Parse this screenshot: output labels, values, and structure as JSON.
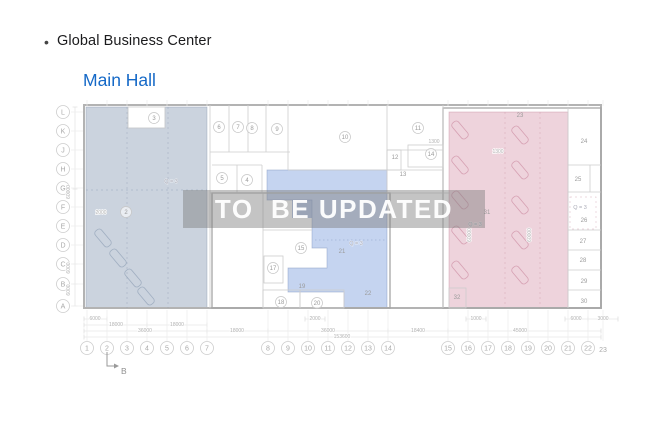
{
  "header": {
    "bullet": "•",
    "title": "Global Business Center",
    "subtitle": "Main Hall"
  },
  "watermark": {
    "text": "TO  BE UPDATED"
  },
  "colors": {
    "subtitle_blue": "#1569c7",
    "left_zone": "rgba(151,168,190,0.50)",
    "middle_zone": "rgba(133,166,224,0.48)",
    "middle_zone_dark": "rgba(120,150,210,0.55)",
    "right_zone": "rgba(214,151,172,0.42)",
    "watermark_band": "rgba(125,125,125,0.45)"
  },
  "plan": {
    "section_marker": "B",
    "row_labels": [
      {
        "t": "L",
        "y": 112
      },
      {
        "t": "K",
        "y": 131
      },
      {
        "t": "J",
        "y": 150
      },
      {
        "t": "H",
        "y": 169
      },
      {
        "t": "G",
        "y": 188
      },
      {
        "t": "F",
        "y": 207
      },
      {
        "t": "E",
        "y": 226
      },
      {
        "t": "D",
        "y": 245
      },
      {
        "t": "C",
        "y": 264
      },
      {
        "t": "B",
        "y": 284
      },
      {
        "t": "A",
        "y": 306
      }
    ],
    "col_labels": [
      {
        "t": "1",
        "x": 87
      },
      {
        "t": "2",
        "x": 107
      },
      {
        "t": "3",
        "x": 127
      },
      {
        "t": "4",
        "x": 147
      },
      {
        "t": "5",
        "x": 167
      },
      {
        "t": "6",
        "x": 187
      },
      {
        "t": "7",
        "x": 207
      },
      {
        "t": "8",
        "x": 268
      },
      {
        "t": "9",
        "x": 288
      },
      {
        "t": "10",
        "x": 308
      },
      {
        "t": "11",
        "x": 328
      },
      {
        "t": "12",
        "x": 348
      },
      {
        "t": "13",
        "x": 368
      },
      {
        "t": "14",
        "x": 388
      },
      {
        "t": "15",
        "x": 448
      },
      {
        "t": "16",
        "x": 468
      },
      {
        "t": "17",
        "x": 488
      },
      {
        "t": "18",
        "x": 508
      },
      {
        "t": "19",
        "x": 528
      },
      {
        "t": "20",
        "x": 548
      },
      {
        "t": "21",
        "x": 568
      },
      {
        "t": "22",
        "x": 588
      },
      {
        "t": "23",
        "x": 603,
        "plain": true,
        "y": 352
      }
    ],
    "rooms": [
      {
        "t": "2",
        "x": 126,
        "y": 212,
        "c": true
      },
      {
        "t": "3",
        "x": 154,
        "y": 118,
        "c": true
      },
      {
        "t": "5",
        "x": 222,
        "y": 178,
        "c": true
      },
      {
        "t": "4",
        "x": 247,
        "y": 180,
        "c": true
      },
      {
        "t": "6",
        "x": 219,
        "y": 127,
        "c": true
      },
      {
        "t": "7",
        "x": 238,
        "y": 127,
        "c": true
      },
      {
        "t": "8",
        "x": 252,
        "y": 128,
        "c": true
      },
      {
        "t": "9",
        "x": 277,
        "y": 129,
        "c": true
      },
      {
        "t": "10",
        "x": 345,
        "y": 137,
        "c": true
      },
      {
        "t": "11",
        "x": 418,
        "y": 128,
        "c": true
      },
      {
        "t": "12",
        "x": 395,
        "y": 157
      },
      {
        "t": "13",
        "x": 403,
        "y": 174
      },
      {
        "t": "14",
        "x": 431,
        "y": 154,
        "c": true
      },
      {
        "t": "15",
        "x": 301,
        "y": 248,
        "c": true
      },
      {
        "t": "17",
        "x": 273,
        "y": 268,
        "c": true
      },
      {
        "t": "18",
        "x": 281,
        "y": 302,
        "c": true
      },
      {
        "t": "19",
        "x": 302,
        "y": 286
      },
      {
        "t": "20",
        "x": 317,
        "y": 303,
        "c": true
      },
      {
        "t": "21",
        "x": 342,
        "y": 251
      },
      {
        "t": "22",
        "x": 368,
        "y": 293
      },
      {
        "t": "23",
        "x": 520,
        "y": 115
      },
      {
        "t": "24",
        "x": 584,
        "y": 141
      },
      {
        "t": "25",
        "x": 578,
        "y": 179
      },
      {
        "t": "26",
        "x": 584,
        "y": 220
      },
      {
        "t": "27",
        "x": 583,
        "y": 241
      },
      {
        "t": "28",
        "x": 583,
        "y": 260
      },
      {
        "t": "29",
        "x": 584,
        "y": 281
      },
      {
        "t": "30",
        "x": 584,
        "y": 301
      },
      {
        "t": "31",
        "x": 487,
        "y": 212
      },
      {
        "t": "32",
        "x": 457,
        "y": 297
      }
    ],
    "texts": [
      {
        "t": "6000",
        "x": 95,
        "y": 320
      },
      {
        "t": "18000",
        "x": 116,
        "y": 326
      },
      {
        "t": "18000",
        "x": 177,
        "y": 326
      },
      {
        "t": "36000",
        "x": 145,
        "y": 332
      },
      {
        "t": "18000",
        "x": 237,
        "y": 332
      },
      {
        "t": "2000",
        "x": 315,
        "y": 320
      },
      {
        "t": "36000",
        "x": 328,
        "y": 332
      },
      {
        "t": "18400",
        "x": 418,
        "y": 332
      },
      {
        "t": "1000",
        "x": 476,
        "y": 320
      },
      {
        "t": "45000",
        "x": 520,
        "y": 332
      },
      {
        "t": "6000",
        "x": 576,
        "y": 320
      },
      {
        "t": "3000",
        "x": 603,
        "y": 320
      },
      {
        "t": "153600",
        "x": 342,
        "y": 338
      },
      {
        "t": "60000",
        "x": 70,
        "y": 192,
        "r": -90
      },
      {
        "t": "6000",
        "x": 70,
        "y": 268,
        "r": -90
      },
      {
        "t": "6000",
        "x": 70,
        "y": 290,
        "r": -90
      },
      {
        "t": "60000",
        "x": 471,
        "y": 235,
        "r": -90
      },
      {
        "t": "60000",
        "x": 531,
        "y": 235,
        "r": -90
      },
      {
        "t": "1300",
        "x": 434,
        "y": 143
      },
      {
        "t": "1300",
        "x": 498,
        "y": 153
      },
      {
        "t": "2000",
        "x": 101,
        "y": 214
      },
      {
        "t": "Q = 3",
        "x": 171,
        "y": 183,
        "a": true
      },
      {
        "t": "Q = 3",
        "x": 356,
        "y": 245,
        "a": true
      },
      {
        "t": "Q = 3",
        "x": 475,
        "y": 226,
        "a": true
      },
      {
        "t": "Q = 3",
        "x": 580,
        "y": 209,
        "a": true
      }
    ]
  }
}
